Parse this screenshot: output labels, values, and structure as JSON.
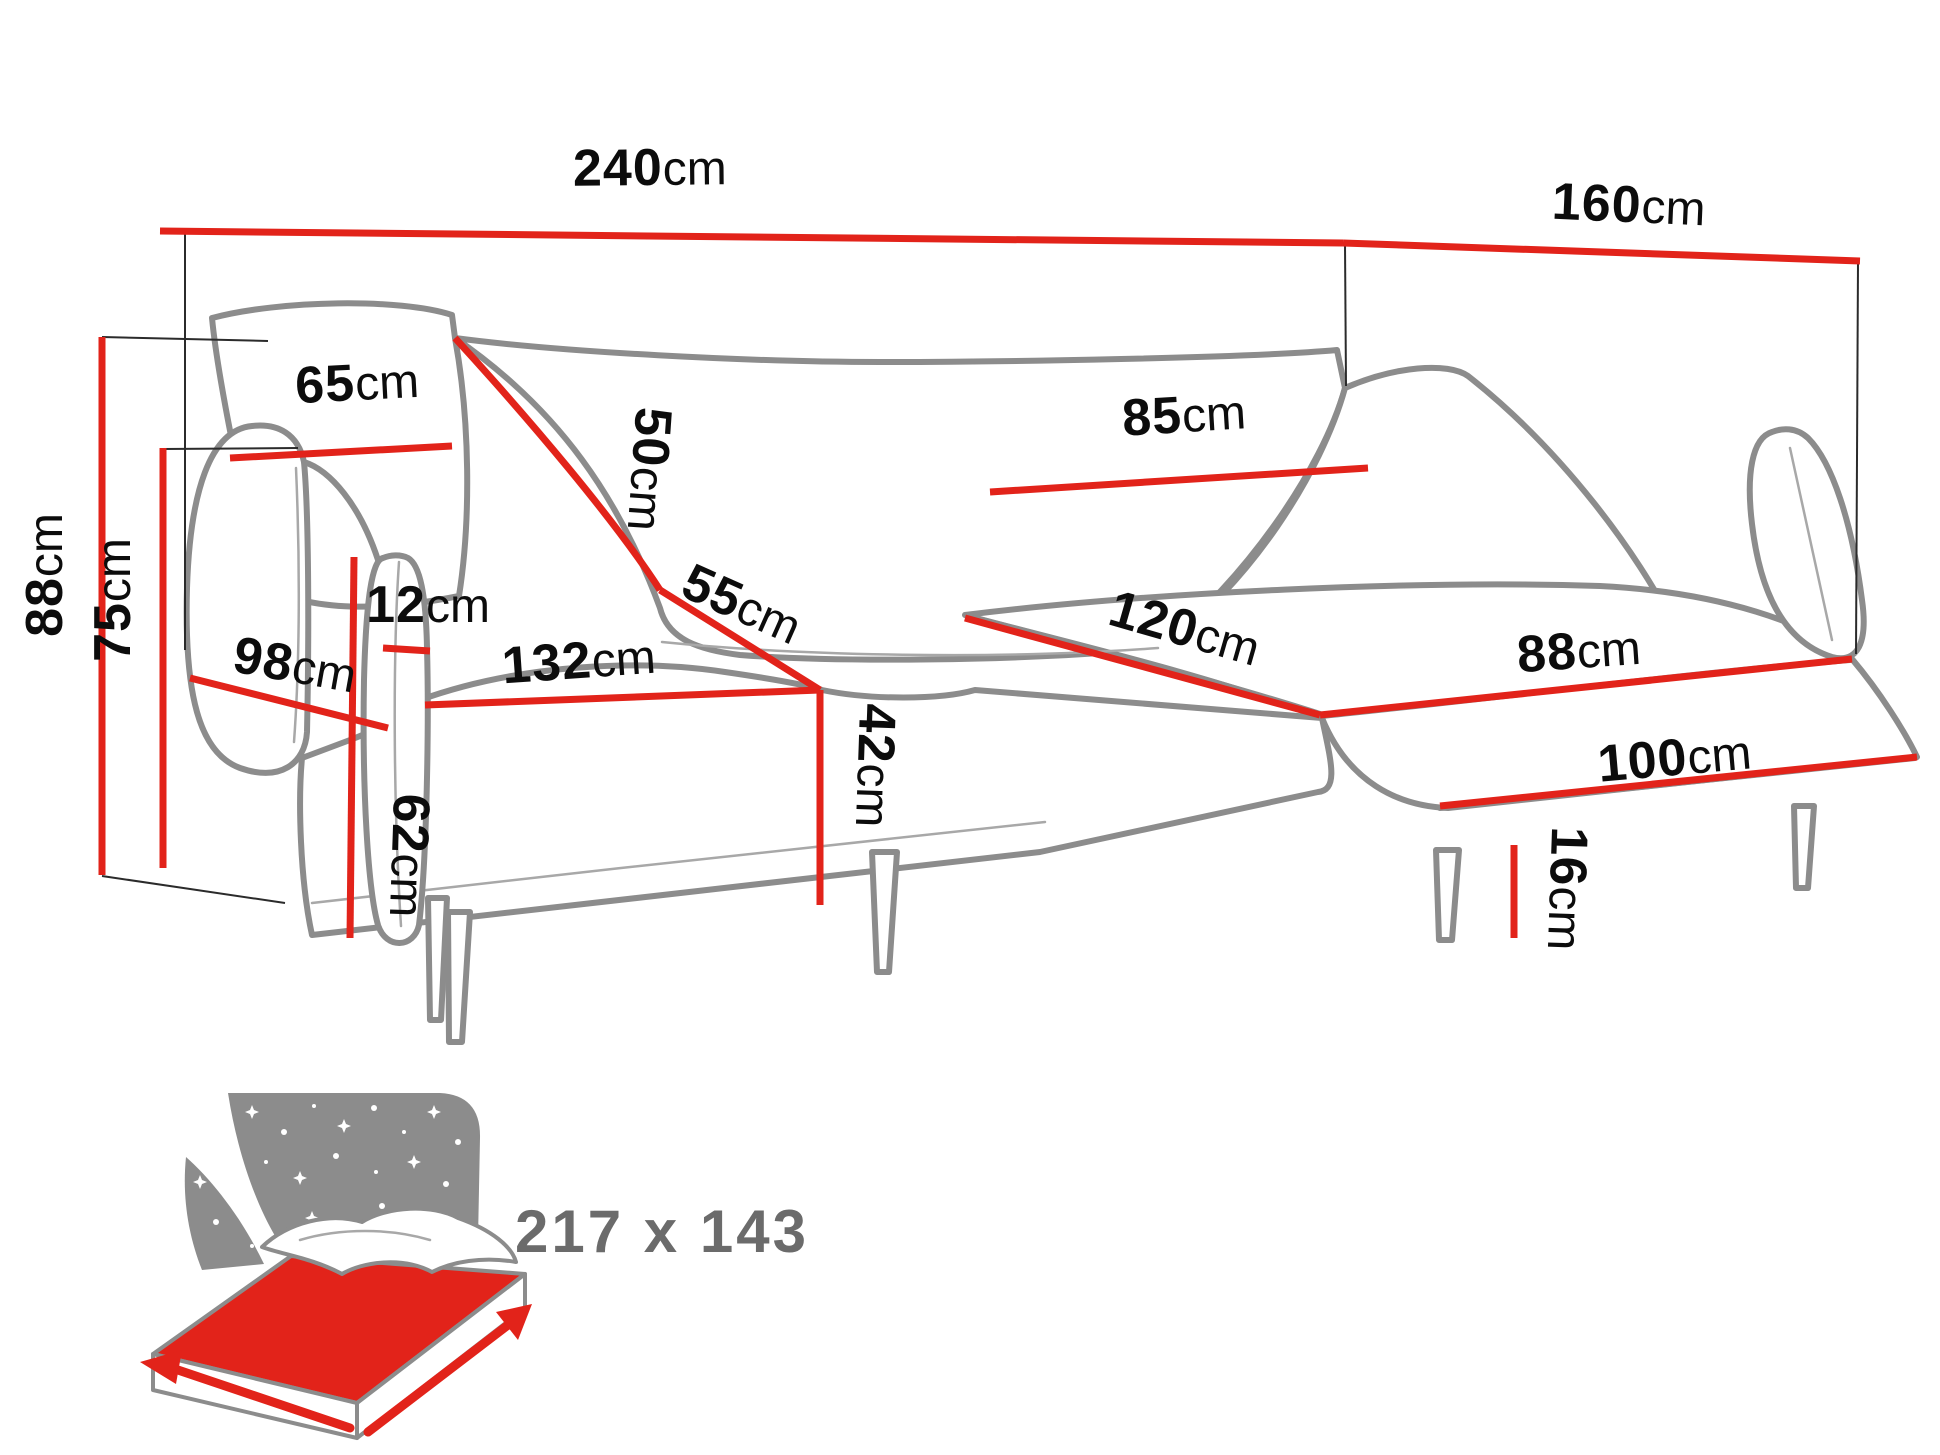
{
  "diagram": {
    "type": "furniture-dimension-diagram",
    "subject": "corner sofa with chaise",
    "colors": {
      "dimension_line": "#e2231a",
      "sofa_outline": "#8c8c8c",
      "label_text": "#0c0c0c",
      "sleeping_text": "#6b6b6b",
      "background": "#ffffff"
    },
    "icons": {
      "sleeping_function": "bed-night-sky-icon"
    },
    "dims": {
      "total_width": {
        "v": "240",
        "u": "cm"
      },
      "total_depth": {
        "v": "160",
        "u": "cm"
      },
      "total_height": {
        "v": "88",
        "u": "cm"
      },
      "backrest_height": {
        "v": "75",
        "u": "cm"
      },
      "back_cushion_left_width": {
        "v": "65",
        "u": "cm"
      },
      "back_cushion_height": {
        "v": "50",
        "u": "cm"
      },
      "back_cushion_right_width": {
        "v": "85",
        "u": "cm"
      },
      "armrest_thickness": {
        "v": "12",
        "u": "cm"
      },
      "armrest_depth": {
        "v": "98",
        "u": "cm"
      },
      "seat_width": {
        "v": "132",
        "u": "cm"
      },
      "seat_depth": {
        "v": "55",
        "u": "cm"
      },
      "seat_height": {
        "v": "42",
        "u": "cm"
      },
      "armrest_front_height": {
        "v": "62",
        "u": "cm"
      },
      "chaise_width": {
        "v": "120",
        "u": "cm"
      },
      "chaise_top_length": {
        "v": "88",
        "u": "cm"
      },
      "chaise_side_length": {
        "v": "100",
        "u": "cm"
      },
      "leg_height": {
        "v": "16",
        "u": "cm"
      }
    },
    "sleeping_area": {
      "label": "217 x 143"
    }
  }
}
